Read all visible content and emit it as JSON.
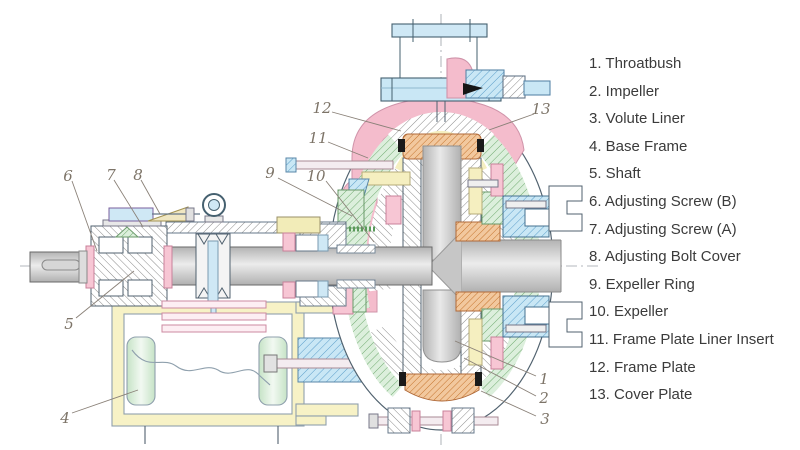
{
  "figure": {
    "type": "engineering-cross-section",
    "subject": "Horizontal slurry pump sectional drawing with numbered part callouts"
  },
  "legend": {
    "items": [
      {
        "label": "1. Throatbush"
      },
      {
        "label": "2. Impeller"
      },
      {
        "label": "3. Volute Liner"
      },
      {
        "label": "4. Base Frame"
      },
      {
        "label": "5. Shaft"
      },
      {
        "label": "6. Adjusting Screw (B)"
      },
      {
        "label": "7. Adjusting Screw (A)"
      },
      {
        "label": "8. Adjusting Bolt Cover"
      },
      {
        "label": "9. Expeller Ring"
      },
      {
        "label": "10. Expeller"
      },
      {
        "label": "11. Frame Plate Liner Insert"
      },
      {
        "label": "12. Frame Plate"
      },
      {
        "label": "13. Cover Plate"
      }
    ]
  },
  "callouts": [
    {
      "n": "1"
    },
    {
      "n": "2"
    },
    {
      "n": "3"
    },
    {
      "n": "4"
    },
    {
      "n": "5"
    },
    {
      "n": "6"
    },
    {
      "n": "7"
    },
    {
      "n": "8"
    },
    {
      "n": "9"
    },
    {
      "n": "10"
    },
    {
      "n": "11"
    },
    {
      "n": "12"
    },
    {
      "n": "13"
    }
  ],
  "colors": {
    "frame_plate_pink": "#f4bccc",
    "liner_green_fill": "#dcefdc",
    "flange_blue_fill": "#c9e7f5",
    "impeller_orange_fill": "#f2c89e",
    "base_frame_yellow": "#f7f2c6",
    "shaft_gray": "#c9c9c9",
    "legend_text": "#3b3b3b",
    "callout_text": "#7d7468",
    "outline": "#51626f"
  }
}
